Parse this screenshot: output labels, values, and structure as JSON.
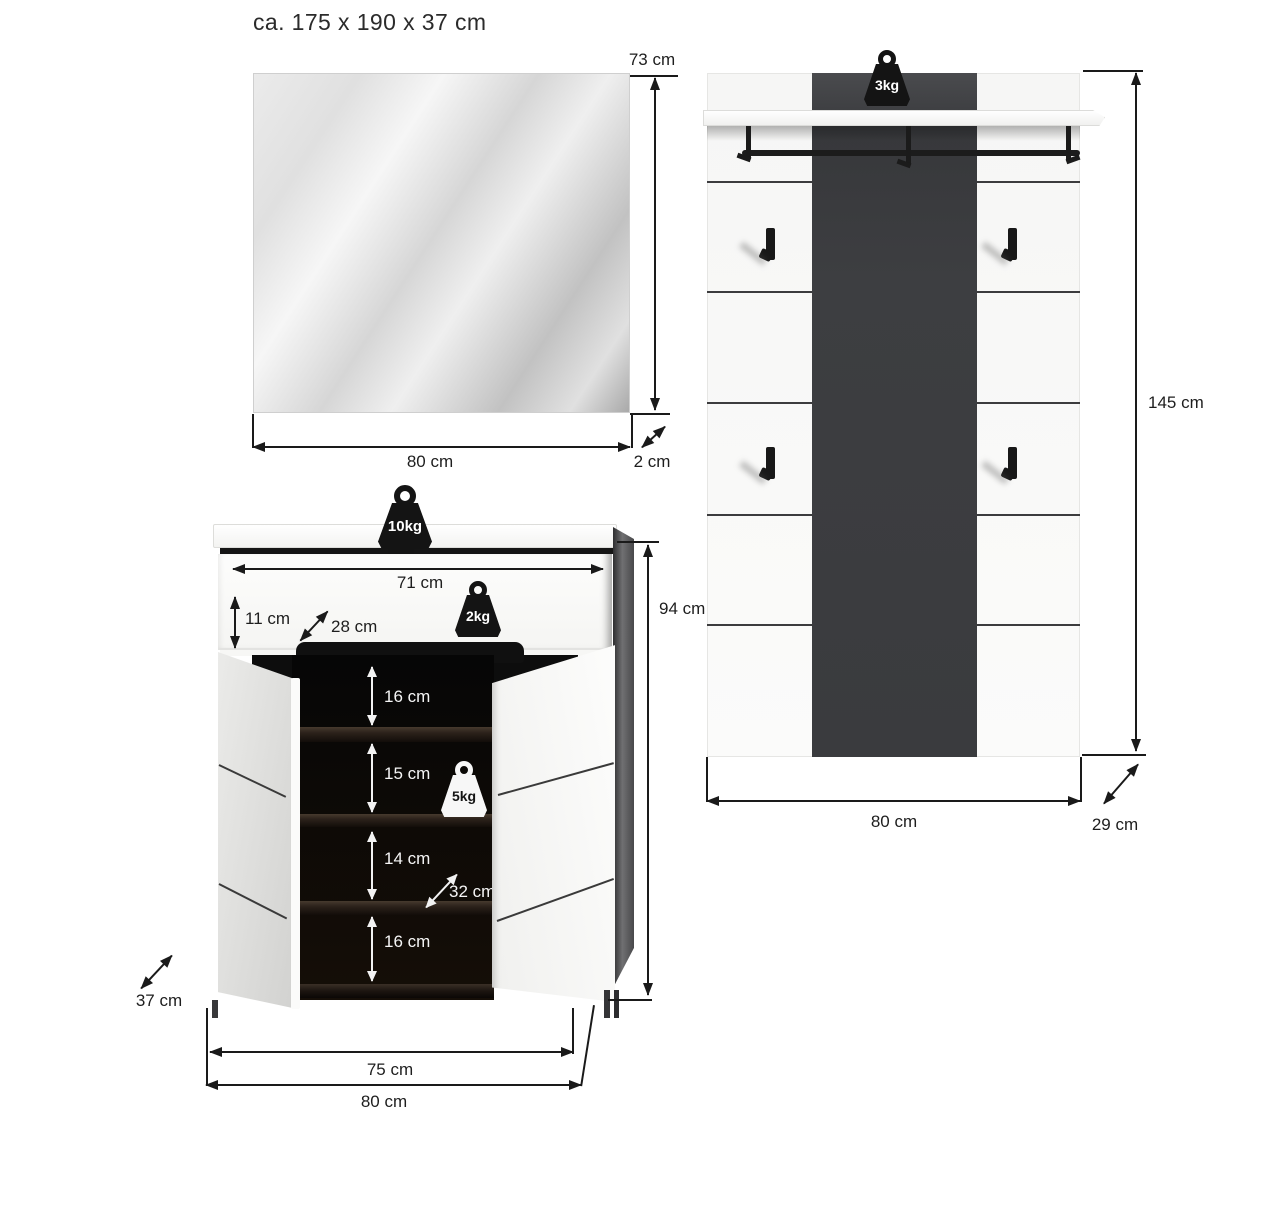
{
  "title": "ca. 175 x 190 x 37 cm",
  "mirror": {
    "width": "80 cm",
    "height": "73 cm",
    "depth": "2 cm"
  },
  "panel": {
    "capacity": "3kg",
    "height": "145 cm",
    "width": "80 cm",
    "depth": "29 cm"
  },
  "cabinet": {
    "top_capacity": "10kg",
    "drawer_capacity": "2kg",
    "shelf_capacity": "5kg",
    "inner_width": "71 cm",
    "drawer_height": "11 cm",
    "drawer_depth": "28 cm",
    "height": "94 cm",
    "shelf_gaps": [
      "16 cm",
      "15 cm",
      "14 cm",
      "16 cm"
    ],
    "inner_depth": "32 cm",
    "depth": "37 cm",
    "inner_width_bottom": "75 cm",
    "width": "80 cm"
  },
  "colors": {
    "line": "#1a1a1a",
    "panel_dark": "#3d3e41",
    "interior": "#0c0a08"
  }
}
